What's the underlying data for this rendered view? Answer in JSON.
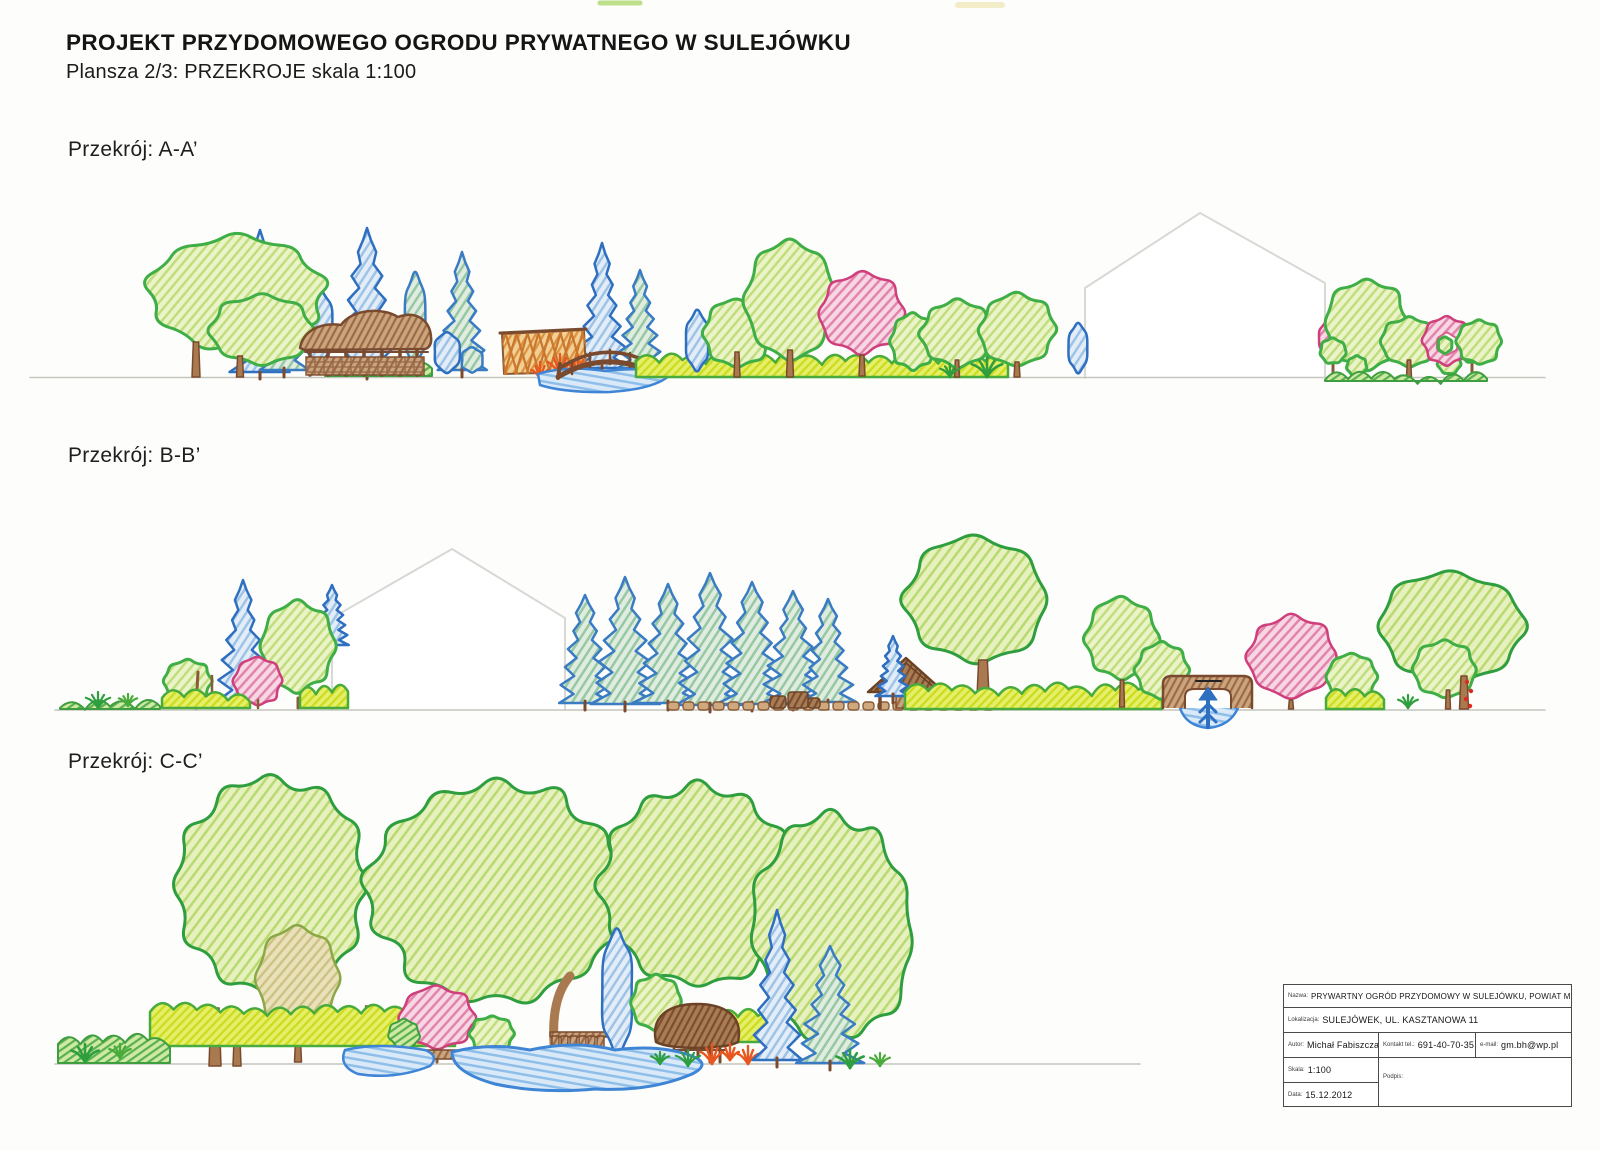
{
  "header": {
    "title": "PROJEKT PRZYDOMOWEGO OGRODU PRYWATNEGO W SULEJÓWKU",
    "subtitle": "Plansza 2/3: PRZEKROJE skala 1:100"
  },
  "sections": {
    "a": {
      "label": "Przekrój: A-A’"
    },
    "b": {
      "label": "Przekrój: B-B’"
    },
    "c": {
      "label": "Przekrój: C-C’"
    }
  },
  "title_block": {
    "name_label": "Nazwa:",
    "name": "PRYWARTNY OGRÓD PRZYDOMOWY W SULEJÓWKU, POWIAT MIŃSKI",
    "location_label": "Lokalizacja:",
    "location": "SULEJÓWEK, UL. KASZTANOWA 11",
    "author_label": "Autor:",
    "author": "Michał Fabiszczak",
    "phone_label": "Kontakt tel.:",
    "phone": "691-40-70-35",
    "email_label": "e-mail:",
    "email": "gm.bh@wp.pl",
    "scale_label": "Skala:",
    "scale": "1:100",
    "signature_label": "Podpis:",
    "date_label": "Data:",
    "date": "15.12.2012"
  },
  "colors": {
    "leaf_green_outline": "#3fae46",
    "dark_leaf_outline": "#2f9e3f",
    "conifer_blue": "#2f6fc0",
    "conifer_teal": "#3a7cc4",
    "pink_tree": "#cf3f7c",
    "wood_brown": "#7a4a2e",
    "water_blue": "#3f85d6",
    "hedge_chartreuse": "#ccdc1f",
    "house_outline_gray": "#d8d8d4",
    "ground_line_gray": "#c5c5c0"
  }
}
